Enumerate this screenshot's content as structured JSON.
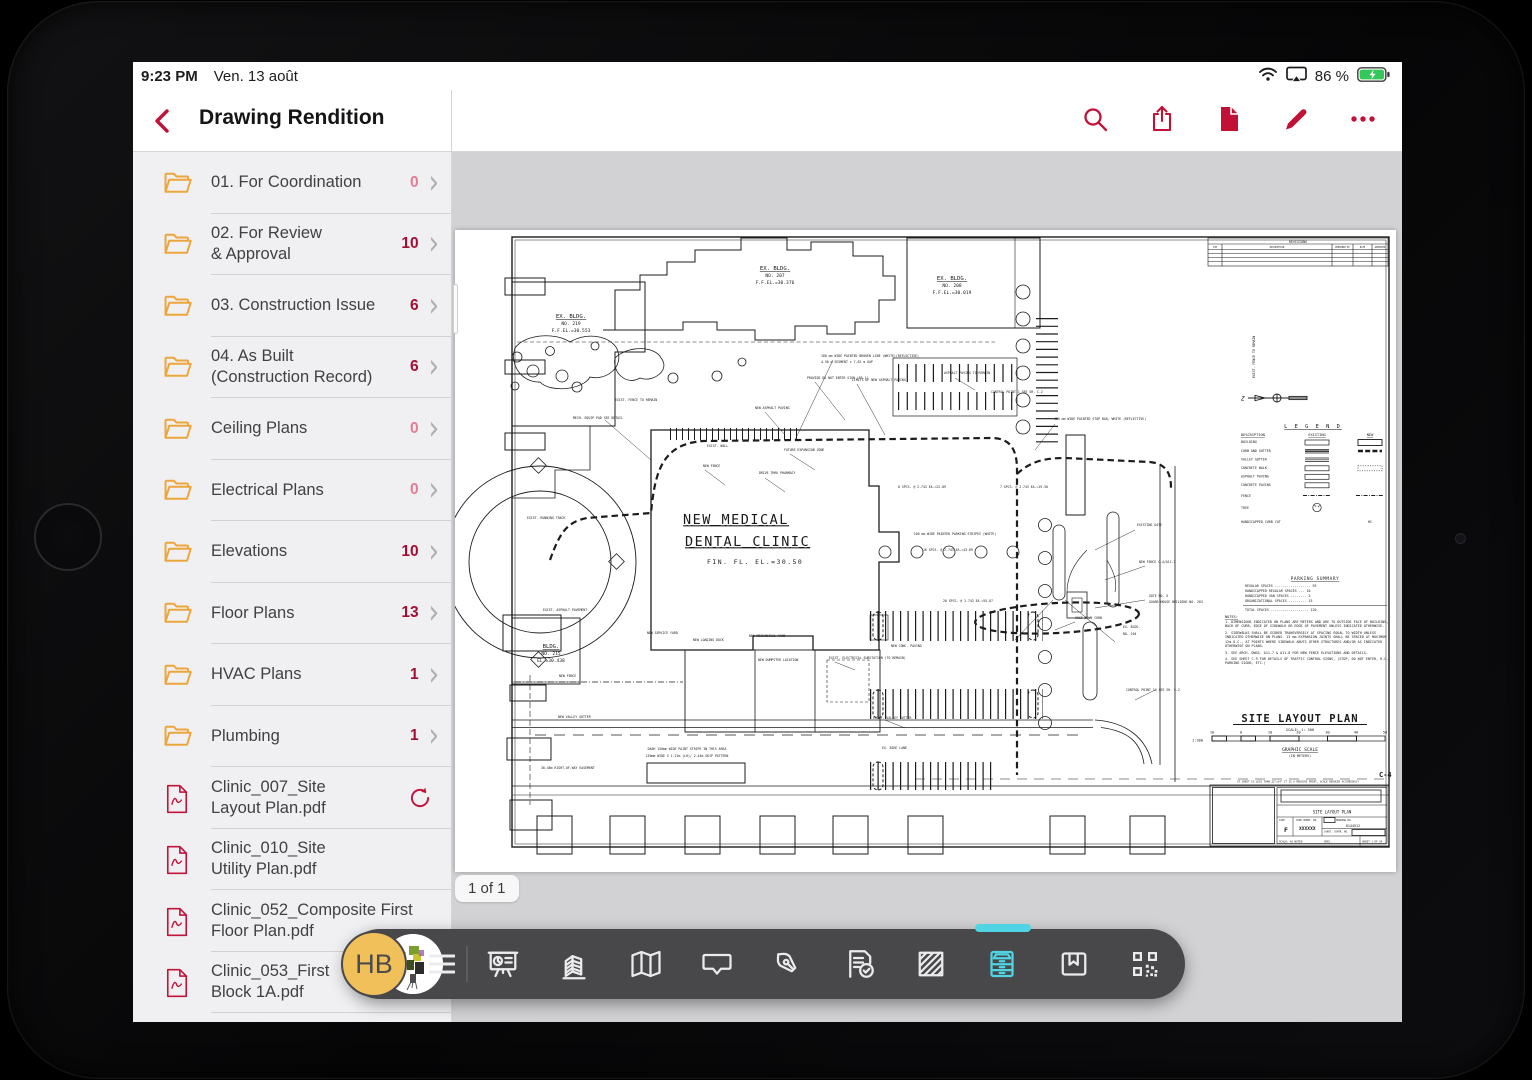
{
  "status_bar": {
    "time": "9:23 PM",
    "date": "Ven. 13 août",
    "battery_percent": "86 %",
    "icons": [
      "wifi-icon",
      "screen-mirroring-icon",
      "battery-charging-icon"
    ]
  },
  "nav": {
    "title": "Drawing Rendition",
    "icons": [
      "back-chevron-icon",
      "search-icon",
      "share-icon",
      "document-icon",
      "edit-pencil-icon",
      "more-ellipsis-icon"
    ]
  },
  "sidebar": {
    "folders": [
      {
        "label": "01. For Coordination",
        "count": "0"
      },
      {
        "label": "02. For Review\n& Approval",
        "count": "10"
      },
      {
        "label": "03. Construction Issue",
        "count": "6"
      },
      {
        "label": "04. As Built\n(Construction Record)",
        "count": "6"
      },
      {
        "label": "Ceiling Plans",
        "count": "0"
      },
      {
        "label": "Electrical Plans",
        "count": "0"
      },
      {
        "label": "Elevations",
        "count": "10"
      },
      {
        "label": "Floor Plans",
        "count": "13"
      },
      {
        "label": "HVAC Plans",
        "count": "1"
      },
      {
        "label": "Plumbing",
        "count": "1"
      }
    ],
    "files": [
      {
        "label": "Clinic_007_Site\nLayout Plan.pdf",
        "sync": true
      },
      {
        "label": "Clinic_010_Site\nUtility Plan.pdf",
        "sync": false
      },
      {
        "label": "Clinic_052_Composite First\nFloor Plan.pdf",
        "sync": false
      },
      {
        "label": "Clinic_053_First\nBlock 1A.pdf",
        "sync": false
      }
    ]
  },
  "viewer": {
    "page_indicator": "1 of 1"
  },
  "toolbar": {
    "avatar_initials": "HB",
    "icons": [
      "slideshow-icon",
      "building-icon",
      "map-icon",
      "comment-icon",
      "pen-icon",
      "form-check-icon",
      "hatch-icon",
      "drawers-icon",
      "bookmark-icon",
      "qr-code-icon"
    ],
    "active_icon": "drawers-icon",
    "active_color": "#4fd4e4"
  },
  "colors": {
    "accent_red": "#c21136",
    "count_red": "#a50e34",
    "count_zero": "#e27d97",
    "folder_yellow": "#eca63c",
    "teal": "#4fd4e4",
    "toolbar_bg": "#48484b",
    "viewer_bg": "#d2d2d4",
    "sidebar_bg": "#f0f0f2",
    "battery_green": "#34c759"
  },
  "drawing": {
    "revisions_title": "REVISIONS",
    "revisions_cols": [
      "SYM",
      "DESCRIPTION",
      "PREPARED BY",
      "DATE",
      "APPROVED"
    ],
    "buildings": {
      "b219": {
        "l1": "EX. BLDG.",
        "l2": "NO. 219",
        "l3": "F.F.EL.=30.553"
      },
      "b207": {
        "l1": "EX. BLDG.",
        "l2": "NO. 207",
        "l3": "F.F.EL.=30.376"
      },
      "b208": {
        "l1": "EX. BLDG.",
        "l2": "NO. 208",
        "l3": "F.F.EL.=30.019"
      },
      "b215": {
        "l1": "BLDG.",
        "l2": "NO. 215",
        "l3": "EL.=30.438"
      }
    },
    "clinic": {
      "l1": "NEW MEDICAL",
      "l2": "DENTAL CLINIC",
      "l3": "FIN. FL. EL.=30.50"
    },
    "legend": {
      "title": "L E G E N D",
      "col_desc": "DESCRIPTION",
      "col_existing": "EXISTING",
      "col_new": "NEW",
      "rows": [
        "BUILDING",
        "CURB AND GUTTER",
        "VALLEY GUTTER",
        "CONCRETE WALK",
        "ASPHALT PAVING",
        "CONCRETE PAVING",
        "FENCE",
        "TREE",
        "HANDICAPPED CURB CUT"
      ],
      "hc": "HC"
    },
    "parking_summary": {
      "title": "PARKING SUMMARY",
      "rows": [
        "REGULAR SPACES ------------------ 93",
        "HANDICAPPED REGULAR SPACES --- 10",
        "HANDICAPPED VAN SPACES -------- 2",
        "ORGANIZATIONAL SPACES --------- 15"
      ],
      "total": "TOTAL SPACES ------------------- 120"
    },
    "notes": {
      "title": "NOTES:",
      "items": [
        "1. DIMENSIONS INDICATED ON PLANS ARE METERS AND ARE TO OUTSIDE FACE OF BUILDING, BACK OF CURB, EDGE OF SIDEWALK OR EDGE OF PAVEMENT UNLESS INDICATED OTHERWISE.",
        "2. SIDEWALKS SHALL BE SCORED TRANSVERSELY AT SPACING EQUAL TO WIDTH UNLESS INDICATED OTHERWISE ON PLANS. 13 mm EXPANSION JOINTS SHALL BE SPACED AT MAXIMUM 12m O.C., AT POINTS WHERE SIDEWALK ABUTS OTHER STRUCTURES AND/OR AS INDICATED OTHERWISE ON PLANS.",
        "3. SEE ARCH. DWGS. A11-7 & A11-8 FOR NEW FENCE ELEVATIONS AND DETAILS.",
        "4. SEE SHEET C-9 FOR DETAILS OF TRAFFIC CONTROL SIGNS, (STOP, DO NOT ENTER, H.C. PARKING SIGNS, ETC.)"
      ]
    },
    "plan_title": "SITE LAYOUT PLAN",
    "plan_scale": "SCALE: 1: 300",
    "scale_numbers": [
      "10",
      "0",
      "10",
      "20",
      "30",
      "40",
      "50"
    ],
    "scale_ratio": "1:300",
    "graphic_scale": "GRAPHIC SCALE",
    "graphic_units": "(IN METERS)",
    "sheet_no": "C-4",
    "titleblock": {
      "note": "IF SHEET IS LESS THAN 22\"x34\" IT IS A REDUCED PRINT, SCALE REDUCED ACCORDINGLY",
      "title": "SITE LAYOUT PLAN",
      "size_label": "SIZE",
      "size": "F",
      "code_label": "CODE IDENT. NO.",
      "code": "XXXXXX",
      "dwg_label": "DRAWING NO.",
      "dwg": "8144512",
      "contr_label": "CONST. CONTR. NO.",
      "scale": "SCALE: AS NOTED",
      "spec": "SPEC.",
      "sheet": "SHEET 1 OF XX"
    },
    "annotations": [
      "EXIST. FENCE TO REMAIN",
      "EXIST. ASPHALT PAVEMENT",
      "MECH. EQUIP PAD SEE DETAIL",
      "NEW ASPHALT PAVING",
      "NEW FENCE",
      "PROVIDE DO NOT ENTER SIGN (R5-1)",
      "LIMITS OF NEW ASPHALT PAVING",
      "ASPHALT PAVING TO REMAIN",
      "CONTROL POINT 1 SEE SH. C-2",
      "450 mm WIDE PAINTED STOP BAR, WHITE (REFLECTIVE)",
      "DRIVE THRU PHARMACY",
      "FUTURE EXPANSION ZONE",
      "EXISTING GATE",
      "NEW FENCE C-4/A11-7",
      "GATE NO. 5",
      "GUARD HOUSE BUILDING NO. 203",
      "EX. BLDG.",
      "NO. 204",
      "CONTROL POINT 10  SEE SH. C-2",
      "HOSE-DOWN CURB",
      "EXIST. ELECTRICAL SUBSTATION (TO REMAIN)",
      "NEW SERVICE YARD",
      "NEW LOADING DOCK",
      "NEW MECHANICAL YARD",
      "NEW DUMPSTER LOCATION",
      "EXIST. VALLEY GUTTER",
      "EX. BIKE LANE",
      "DASH 150mm WIDE PAINT STRIPE IN THIS AREA",
      "150mm WIDE X 1.22m (LH)/ 2.44m SKIP PATTERN",
      "30.48m RIGHT-OF-WAY EASEMENT",
      "NEW VALLEY GUTTER",
      "EXIST. RUNNING TRACK",
      "EXIST. FENCE TO REMAIN",
      "100 mm WIDE PAINTED BROKEN LINE (WHITE)(REFLECTIVE)",
      "4.50 m SEGMENT x 7.62 m GAP",
      "8 SPCS. @ 2.743  EA.=22.09",
      "7 SPCS. @ 2.743  EA.=19.50",
      "100 mm WIDE PAINTED PARKING STRIPES (WHITE)",
      "16 SPCS. @ 2.743  EA.=43.89",
      "20 SPCS. @ 2.743  EA.=55.07",
      "NEW CONC. PAVING",
      "NEW FENCE",
      "EXIST. WALL"
    ]
  }
}
